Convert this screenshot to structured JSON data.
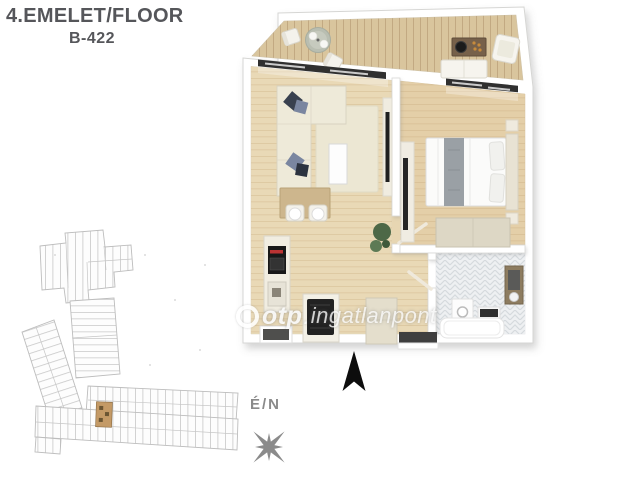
{
  "header": {
    "title": "4.EMELET/FLOOR",
    "unit": "B-422"
  },
  "watermark": {
    "brand": "otp",
    "separator": ".",
    "suffix": "ingatlanpont"
  },
  "compass": {
    "label": "É/N"
  },
  "colors": {
    "title_text": "#55565a",
    "wall": "#ffffff",
    "wall_outline": "#d6d6d4",
    "deck_wood": "#d9c59d",
    "floor_wood": "#e9d9b6",
    "bedroom_wood": "#e4cfa8",
    "sofa_cream": "#eeead9",
    "pillow_navy": "#39414f",
    "pillow_slate": "#7a86a0",
    "rug": "#ece7d3",
    "bathroom_tile": "#eef0f2",
    "window_glass": "#303030",
    "plant_green": "#4d6847",
    "north_arrow": "#0d0d0d",
    "compass_gray": "#8b8b8b",
    "siteplan_line": "#bdbdbd",
    "siteplan_highlight": "#c49a66",
    "watermark_white": "rgba(255,255,255,0.85)"
  }
}
